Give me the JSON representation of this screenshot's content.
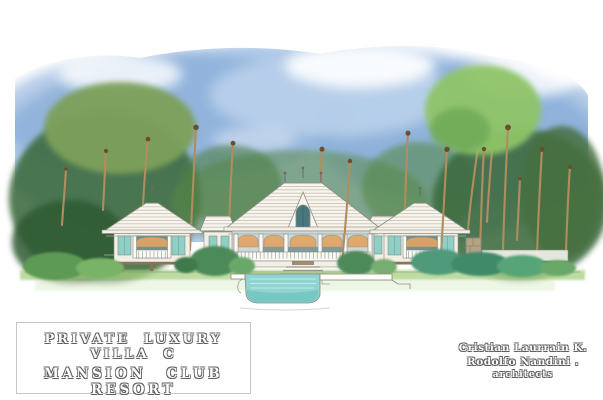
{
  "artwork": {
    "description": "Watercolor architectural front elevation of a tropical luxury villa: three white hip-roofed pavilions with teal walls and verandas, raised on piers, surrounded by coconut palms and dense foliage under a blue sky, with an infinity pool cross-section in the foreground",
    "title_block": {
      "line1": "PRIVATE LUXURY VILLA C",
      "line2": "MANSION CLUB RESORT",
      "location_left": "COËTIVY ISLAND",
      "location_right": "SEYCHELLES"
    },
    "credits": {
      "name1": "Cristian Laurrain K.",
      "name2": "Rodolfo Nandini .",
      "role": "architects"
    }
  },
  "palette": {
    "sky-blue": "#8fb3dd",
    "sky-deep": "#7ba4d4",
    "sky-pale": "#bdd3ec",
    "canopy-dark": "#3d6b3c",
    "canopy-mid": "#5c8a4a",
    "canopy-olive": "#7da05a",
    "canopy-bright": "#8fc468",
    "palm-mid": "#4c8743",
    "palm-light": "#6ca454",
    "palm-dark": "#3c6e38",
    "trunk": "#b08d5e",
    "roof-white": "#f8f5ee",
    "roof-line": "#b5aea0",
    "wall-teal": "#8ecfc6",
    "wall-cream": "#f3efe4",
    "transom-orange": "#e2a463",
    "interior-shadow": "#71908f",
    "pool-water": "#8fd4d0",
    "pool-deep": "#6cc3c1",
    "grass": "#a9d183",
    "grass-pale": "#e4f1d5",
    "stone": "#b3a284",
    "wood": "#8b7355"
  }
}
